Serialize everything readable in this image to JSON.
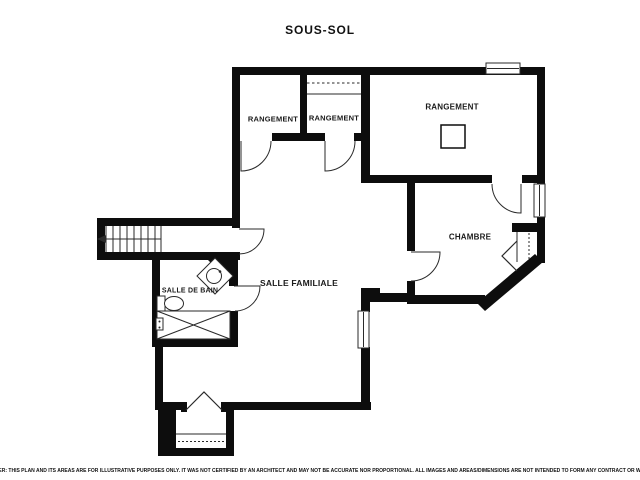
{
  "title": "SOUS-SOL",
  "plan": {
    "rooms": [
      {
        "id": "rangement-left",
        "label": "RANGEMENT"
      },
      {
        "id": "rangement-middle",
        "label": "RANGEMENT"
      },
      {
        "id": "rangement-large",
        "label": "RANGEMENT"
      },
      {
        "id": "chambre",
        "label": "CHAMBRE"
      },
      {
        "id": "salle-familiale",
        "label": "SALLE FAMILIALE"
      },
      {
        "id": "salle-de-bain",
        "label": "SALLE DE BAIN"
      }
    ],
    "fixture_icons": [
      "staircase-icon",
      "bathtub-icon",
      "toilet-icon",
      "corner-sink-icon",
      "column-icon",
      "closet-rod-icon",
      "entry-door-icon",
      "window-icon"
    ]
  },
  "disclaimer": "DISCLAIMER: THIS PLAN AND ITS AREAS ARE FOR ILLUSTRATIVE PURPOSES ONLY. IT WAS NOT CERTIFIED BY AN ARCHITECT AND MAY NOT BE ACCURATE NOR PROPORTIONAL. ALL IMAGES AND AREAS/DIMENSIONS ARE NOT INTENDED TO FORM ANY CONTRACT OR WARRANTY.",
  "colors": {
    "wall": "#0d0d0d",
    "line": "#2a2a2a",
    "background": "#ffffff",
    "text": "#1a1a1a"
  }
}
